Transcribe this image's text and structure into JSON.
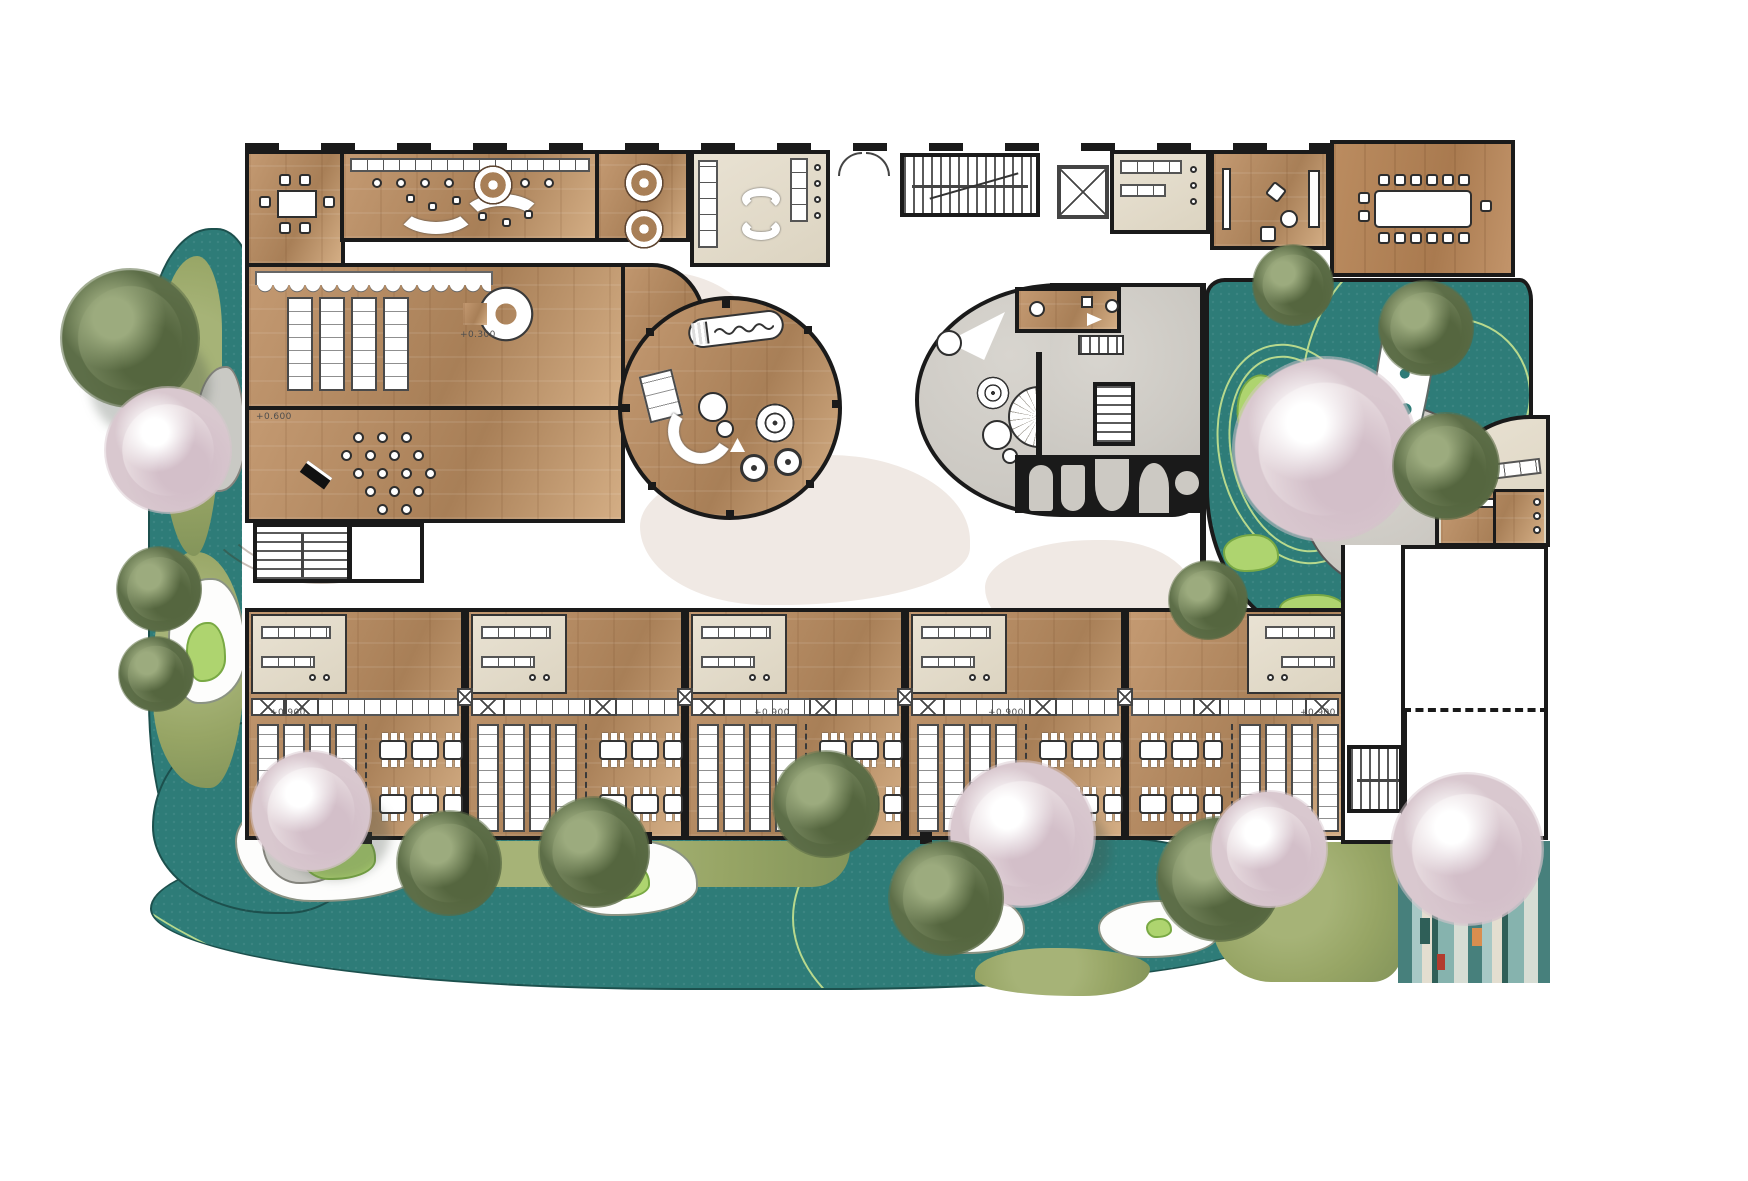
{
  "plan": {
    "kind": "kindergarten-first-floor-rendered-plan",
    "annotations": {
      "a1": "+0.300",
      "a2": "+0.600",
      "a3": "+0.900",
      "a4": "+0.900",
      "a5": "+0.900",
      "a6": "+0.900"
    }
  },
  "colors": {
    "wall": "#1a1a1a",
    "wood": "#c49a72",
    "woodDark": "#a87f57",
    "woodLight": "#d4ae85",
    "beige": "#e6dfd0",
    "concrete": "#ccc9c3",
    "teal": "#2e7c78",
    "laneLine": "#b8d98d",
    "lawn": "#97a565",
    "lime": "#aed46f",
    "blossom": "#e7dbdf",
    "blossomDeep": "#d3bfc9",
    "foliage": "#74845c",
    "foliageDark": "#55663f",
    "hallBlob": "#f0e9e4",
    "accentRed": "#b23b2e",
    "accentOrange": "#d98e4f",
    "accentGreen": "#2f6b4f",
    "stripe1": "#47807c",
    "stripe2": "#a7c8c5",
    "stripe3": "#e3ded0",
    "stripe4": "#2f5f58",
    "stripe5": "#86b3ae",
    "stripe6": "#d7ddd4"
  }
}
